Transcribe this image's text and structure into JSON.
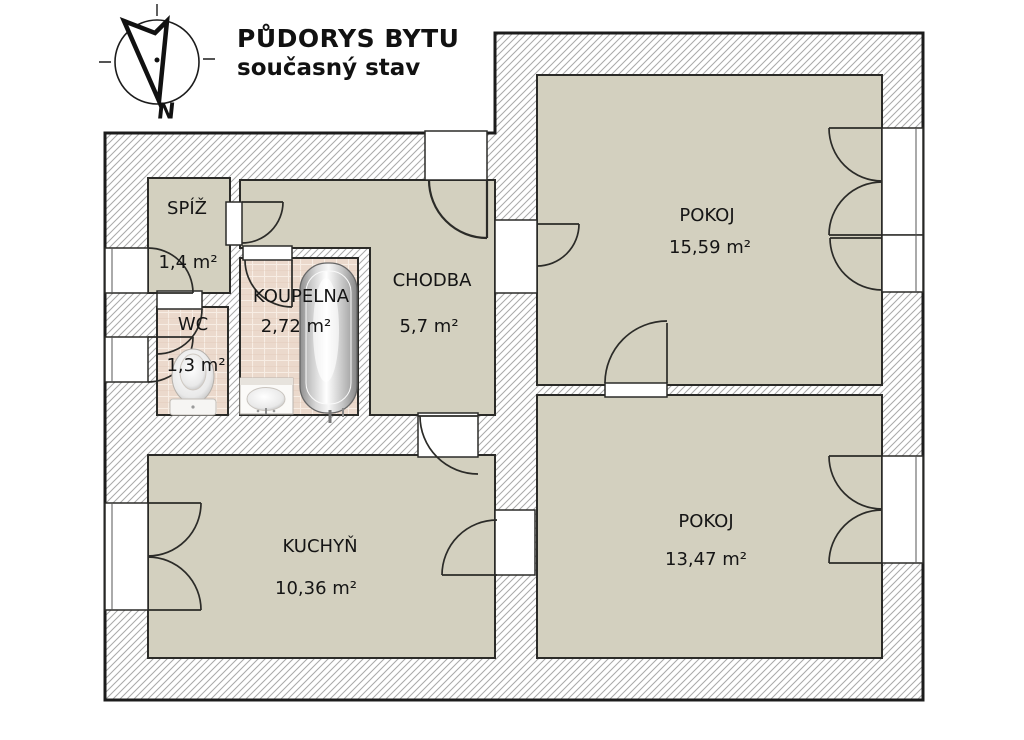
{
  "title": {
    "line1": "PŮDORYS BYTU",
    "line2": "současný stav"
  },
  "compass": {
    "north_label": "N"
  },
  "rooms": {
    "spiz": {
      "name": "SPÍŽ",
      "area": "1,4 m²"
    },
    "wc": {
      "name": "WC",
      "area": "1,3 m²"
    },
    "koupelna": {
      "name": "KOUPELNA",
      "area": "2,72 m²"
    },
    "chodba": {
      "name": "CHODBA",
      "area": "5,7 m²"
    },
    "pokoj1": {
      "name": "POKOJ",
      "area": "15,59 m²"
    },
    "pokoj2": {
      "name": "POKOJ",
      "area": "13,47 m²"
    },
    "kuchyn": {
      "name": "KUCHYŇ",
      "area": "10,36 m²"
    }
  },
  "fixtures": [
    "bathtub",
    "sink",
    "toilet"
  ],
  "colors": {
    "room_fill": "#d3d0bf",
    "tile_fill": "#ebd9cc",
    "wall_hatch_line": "#a9a9a9",
    "outline": "#2b2b28"
  }
}
